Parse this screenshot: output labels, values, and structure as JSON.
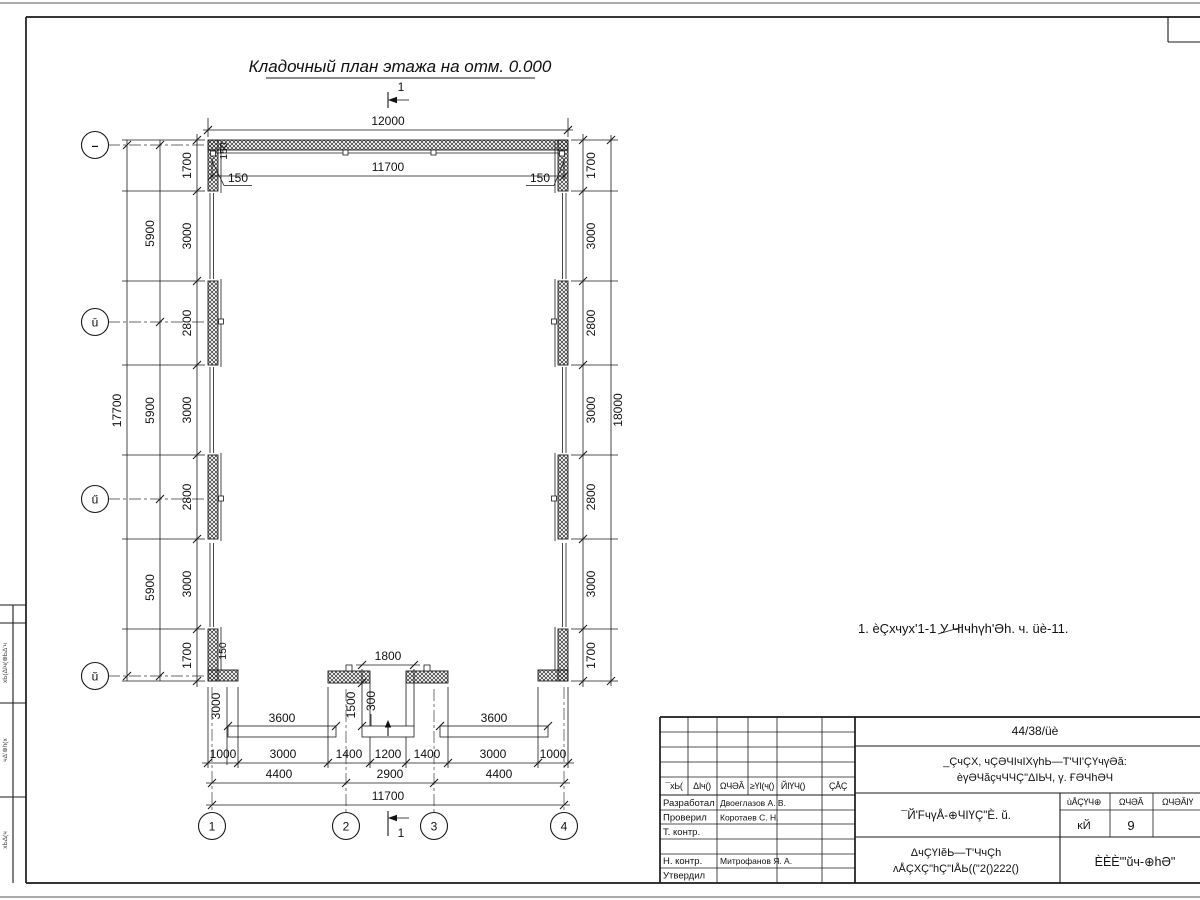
{
  "sheet": {
    "title": "Кладочный план этажа на отм. 0.000",
    "note": "1. èÇхчух'1-1 У ЧIчhүh'Әh. ч. üè-11."
  },
  "plan": {
    "section_label": "1",
    "axes_bottom": [
      "1",
      "2",
      "3",
      "4"
    ],
    "axes_left": [
      "–",
      "ū",
      "ű",
      "ŭ"
    ],
    "dims": {
      "top_total": "12000",
      "top_inner": "11700",
      "offset_left": "150",
      "offset_right": "150",
      "offset_top_left": "150",
      "offset_bottom_left": "150",
      "left_chain": [
        "1700",
        "3000",
        "2800",
        "3000",
        "2800",
        "3000",
        "1700"
      ],
      "left_axis_chain": [
        "5900",
        "5900",
        "5900"
      ],
      "left_total": "17700",
      "right_chain": [
        "1700",
        "3000",
        "2800",
        "3000",
        "2800",
        "3000",
        "1700"
      ],
      "right_total": "18000",
      "bottom_chain": [
        "1000",
        "3000",
        "1400",
        "1200",
        "1400",
        "3000",
        "1000"
      ],
      "bottom_axis_chain": [
        "4400",
        "2900",
        "4400"
      ],
      "bottom_total": "11700",
      "entrance_width": "1800",
      "entrance_depth": "1500",
      "step_depth": "300",
      "apron_left_width": "3000",
      "ramp_left": "3600",
      "ramp_right": "3600"
    }
  },
  "titleblock": {
    "doc_number": "44/38/üè",
    "project_line1": "_ÇчÇX, чÇƏЧIчIXүhЬ—Т'ЧI'ÇҮчүƏă:",
    "project_line2": "èγƏЧăçчЧЧÇ\"ΔIЬЧ, γ. ҒƏЧhƏЧ",
    "drawing_title": "¯Й'FчγÅ-⊕ЧIҮÇ\"È. ŭ.",
    "header_cols": [
      "¯хЬ(",
      "ΔIч()",
      "ΩЧƏĂ",
      "≥ҮI(ч()",
      "ЙIҮЧ()",
      "ÇÅÇ"
    ],
    "sign_rows": [
      {
        "label": "Разработал",
        "name": "Двоеглазов А. В."
      },
      {
        "label": "Проверил",
        "name": "Коротаев С. Н."
      },
      {
        "label": "Т. контр.",
        "name": ""
      },
      {
        "label": "",
        "name": ""
      },
      {
        "label": "Н. контр.",
        "name": "Митрофанов Я. А."
      },
      {
        "label": "Утвердил",
        "name": ""
      }
    ],
    "stage_headers": [
      "ùÅÇҮЧ⊕",
      "ΩЧƏĂ",
      "ΩЧƏĂIҮ"
    ],
    "stage_value": "ĸЙ",
    "sheet_value": "9",
    "bottom_line1": "ΔчÇҮIĕЬ—Т'ЧчÇh",
    "bottom_line2": "ʌÅÇXÇ\"hÇ\"IÅЬ((\"2()222()",
    "company": "ÈÈÈ'\"ŭч-⊕hƏ\""
  },
  "left_margin": {
    "cells": [
      "хЬ(ΔIч(⊕ЬΔ'ч",
      "чΔ'⊕h(х",
      "хЬΔ(ч"
    ]
  }
}
